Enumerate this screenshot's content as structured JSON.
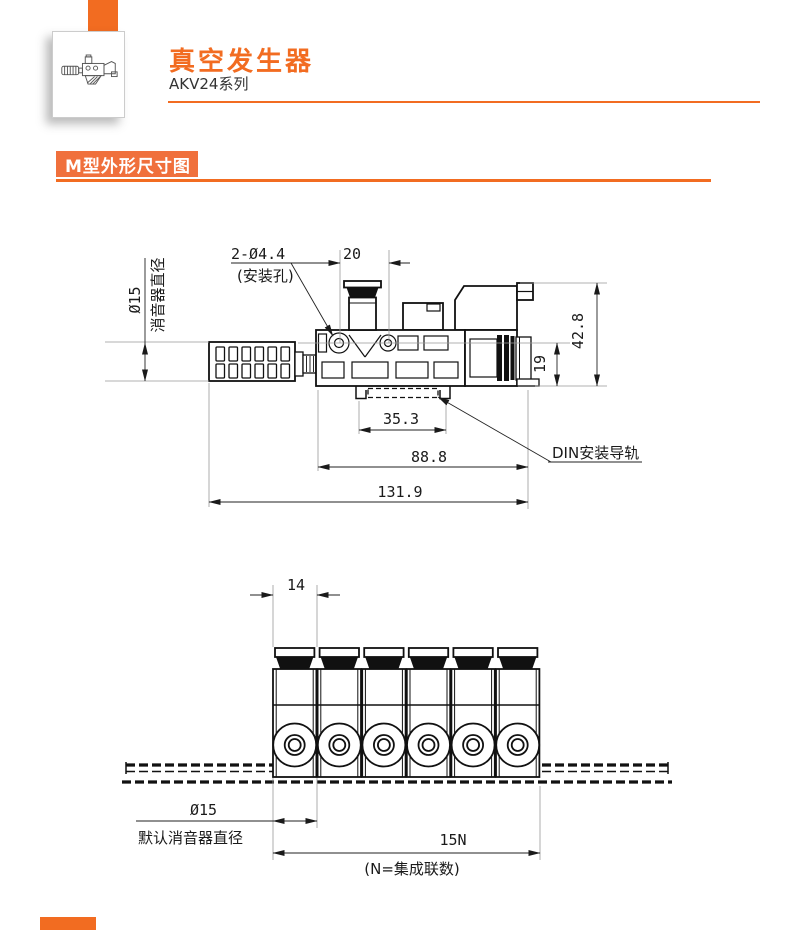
{
  "theme": {
    "accent": "#F26C21",
    "accent_box": "#F0703C",
    "line_color": "#1a1a1a"
  },
  "header": {
    "title": "真空发生器",
    "series": "AKV24系列"
  },
  "section_title": "M型外形尺寸图",
  "side_view": {
    "muffler_dia_label": "Ø15",
    "muffler_label": "消音器直径",
    "mount_holes_label": "2-Ø4.4",
    "mount_holes_note": "(安装孔)",
    "dim_pitch": "20",
    "dim_height_total": "42.8",
    "dim_height_center": "19",
    "dim_rail_width": "35.3",
    "dim_body_length": "88.8",
    "dim_total_length": "131.9",
    "din_rail_label": "DIN安装导轨"
  },
  "front_view": {
    "module_count": 6,
    "dim_module_width": "14",
    "muffler_dia_label": "Ø15",
    "muffler_note": "默认消音器直径",
    "dim_total": "15N",
    "dim_total_note": "(N=集成联数)"
  }
}
